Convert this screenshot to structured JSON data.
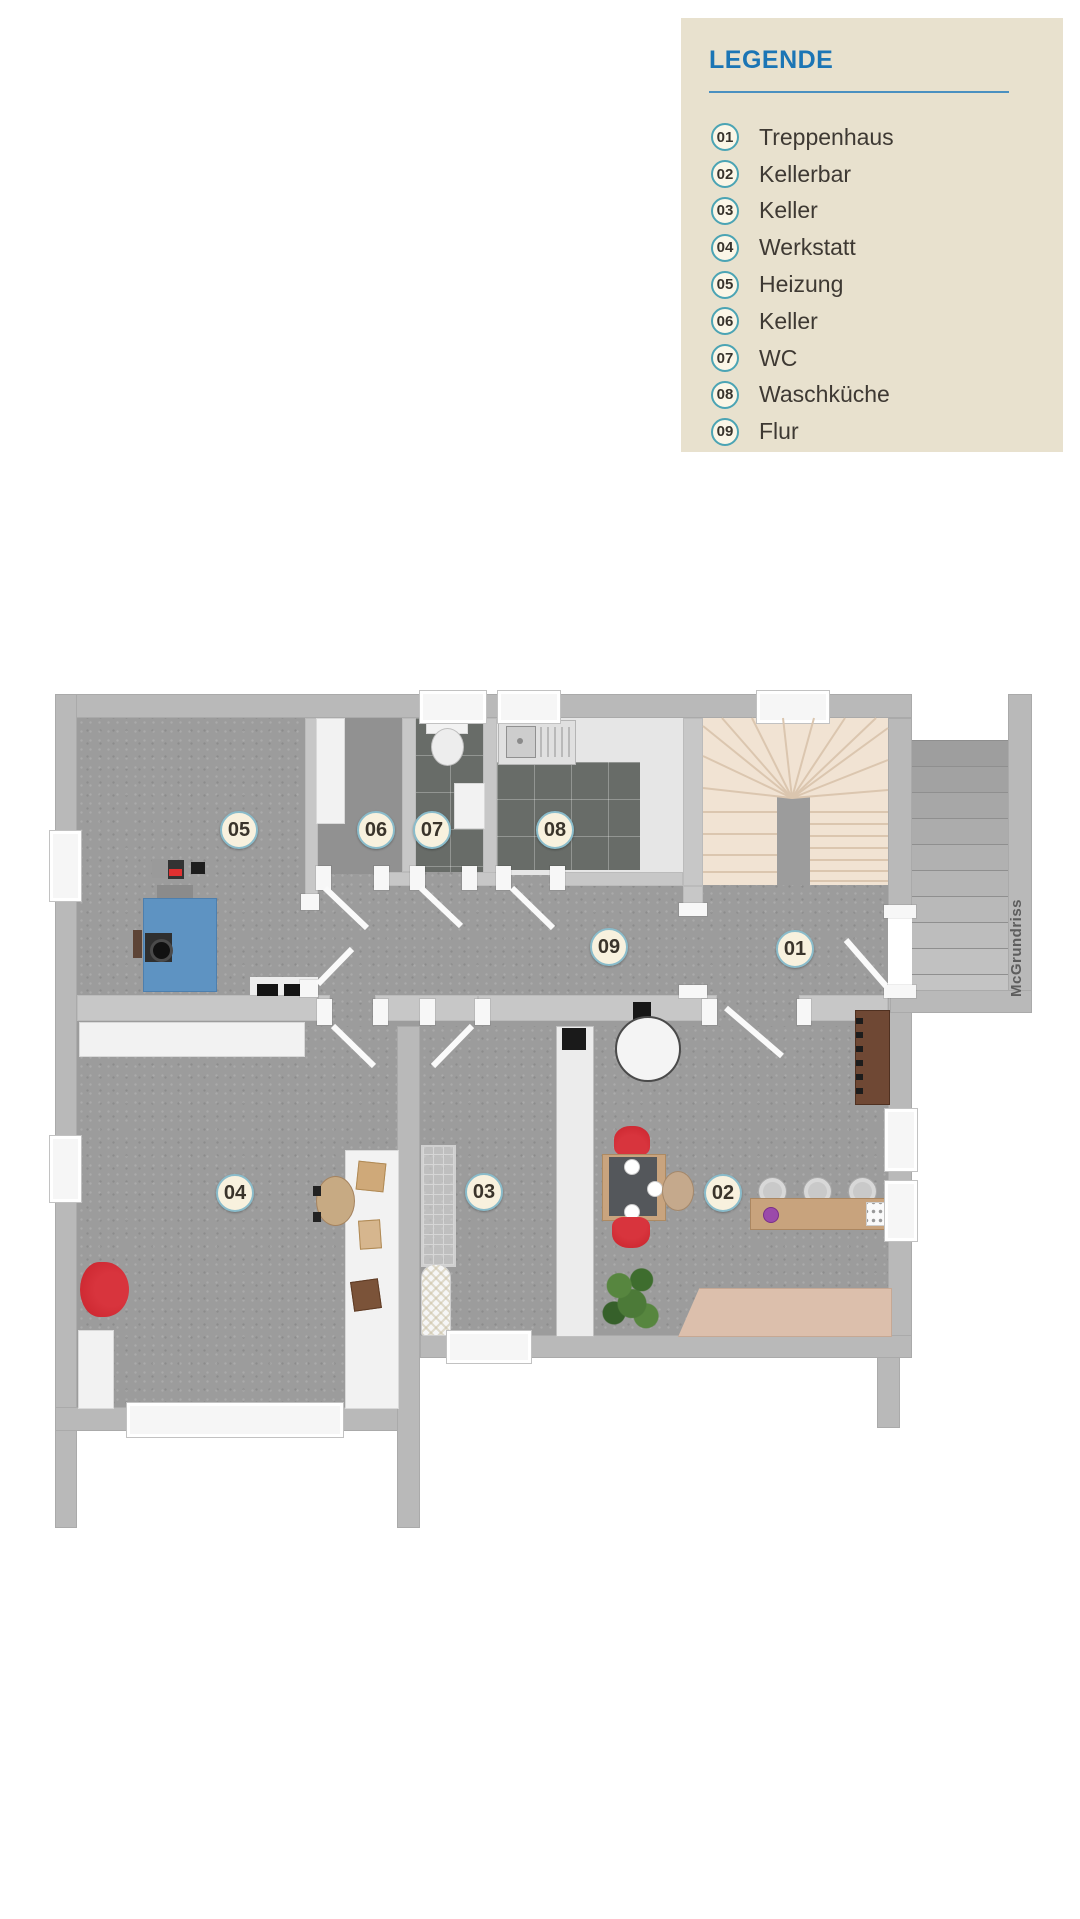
{
  "legend": {
    "title": "LEGENDE",
    "items": [
      {
        "num": "01",
        "label": "Treppenhaus"
      },
      {
        "num": "02",
        "label": "Kellerbar"
      },
      {
        "num": "03",
        "label": "Keller"
      },
      {
        "num": "04",
        "label": "Werkstatt"
      },
      {
        "num": "05",
        "label": "Heizung"
      },
      {
        "num": "06",
        "label": "Keller"
      },
      {
        "num": "07",
        "label": "WC"
      },
      {
        "num": "08",
        "label": "Waschküche"
      },
      {
        "num": "09",
        "label": "Flur"
      }
    ]
  },
  "plan": {
    "watermark": "McGrundriss",
    "room_labels": [
      {
        "num": "01"
      },
      {
        "num": "02"
      },
      {
        "num": "03"
      },
      {
        "num": "04"
      },
      {
        "num": "05"
      },
      {
        "num": "06"
      },
      {
        "num": "07"
      },
      {
        "num": "08"
      },
      {
        "num": "09"
      }
    ]
  },
  "colors": {
    "legend_bg": "#e8e1ce",
    "accent_blue": "#1b75b5",
    "circle_teal": "#4ba4b4",
    "floor_gray": "#9c9c9c",
    "wall_gray": "#b9b9b9",
    "tile_dark": "#686c68",
    "stair_beige": "#f1e3d3",
    "boiler_blue": "#5e93c2",
    "furniture_red": "#cf2a33",
    "wood_light": "#c8a37e",
    "wood_dark": "#6f4834",
    "plan_label_bg": "#f8f1de"
  }
}
